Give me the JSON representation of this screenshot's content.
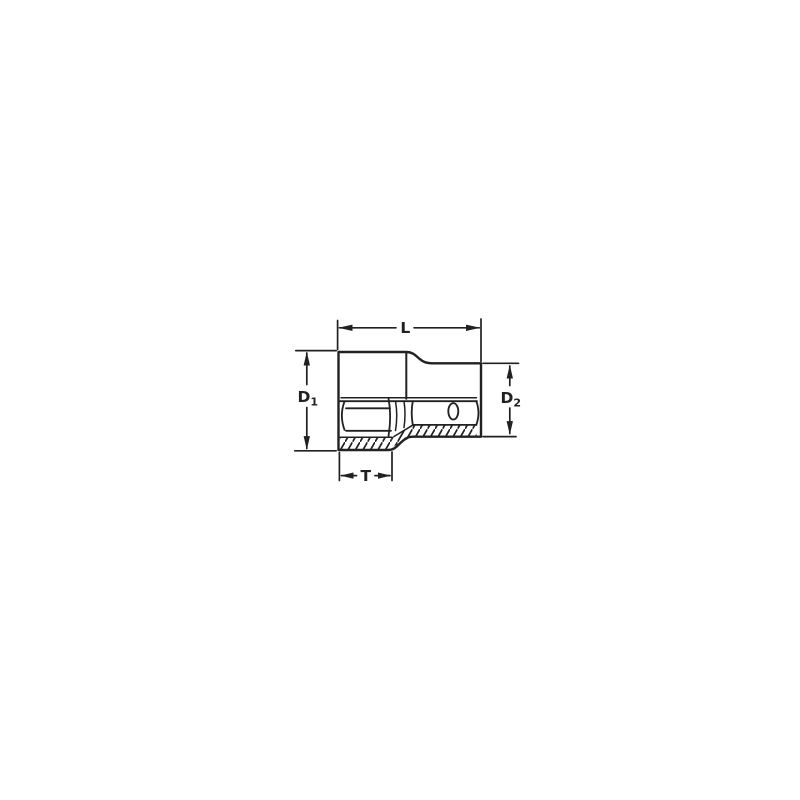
{
  "canvas": {
    "background_color": "#ffffff",
    "line_color": "#212121"
  },
  "drawing": {
    "title": "Socket side-view half-section technical drawing",
    "dimensions": {
      "length": {
        "label": "L"
      },
      "socket_diameter": {
        "base": "D",
        "sub": "1"
      },
      "drive_diameter": {
        "base": "D",
        "sub": "2"
      },
      "hex_section_length": {
        "label": "T"
      }
    }
  }
}
